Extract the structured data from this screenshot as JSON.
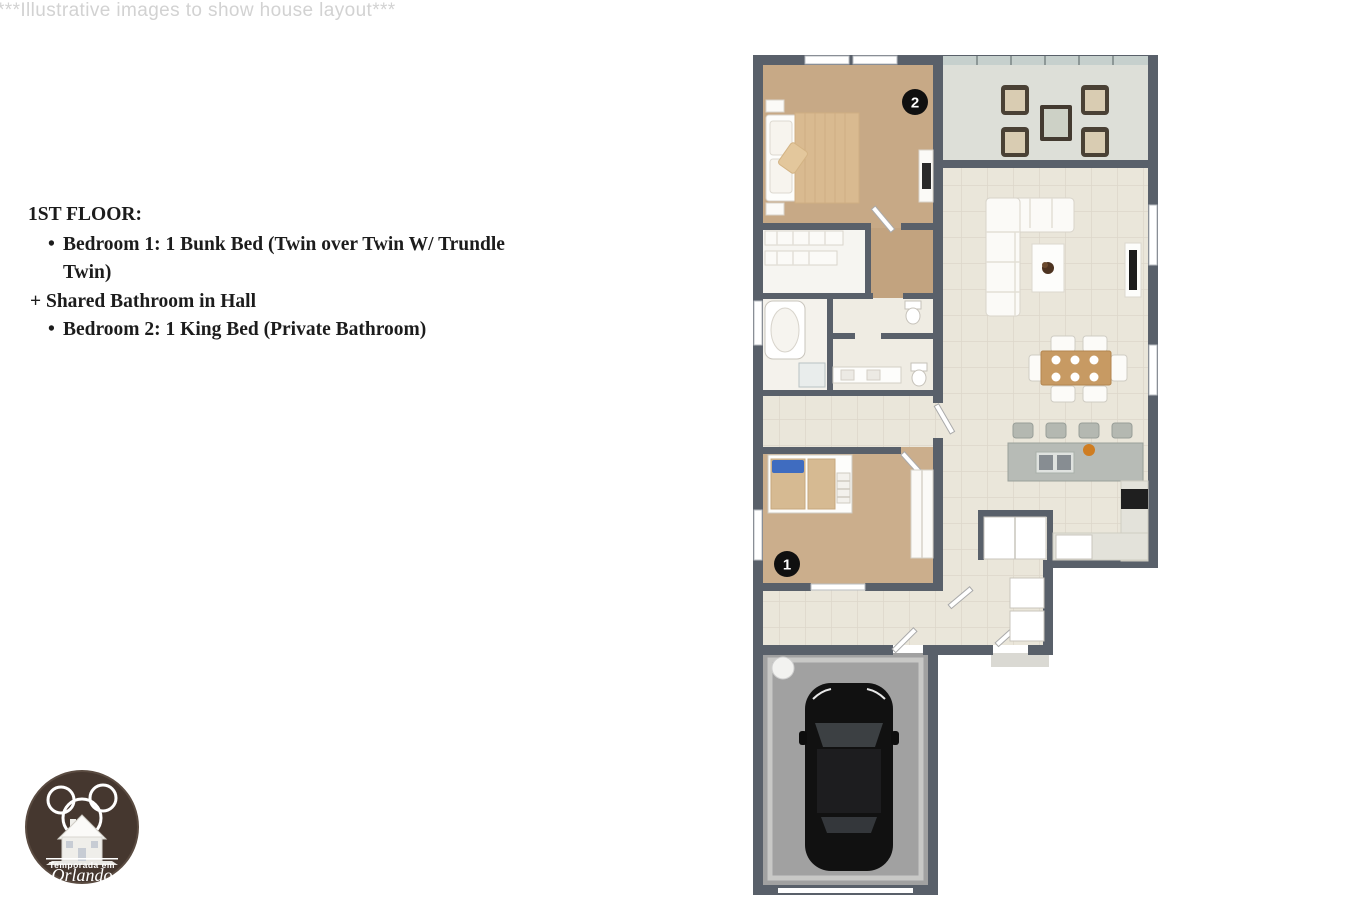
{
  "watermark": "***Illustrative images to show house layout***",
  "info": {
    "title": "1ST FLOOR:",
    "lines": [
      {
        "type": "bullet",
        "text": "Bedroom 1: 1 Bunk Bed (Twin over Twin W/ Trundle Twin)"
      },
      {
        "type": "plain",
        "text": "+ Shared Bathroom in Hall"
      },
      {
        "type": "bullet",
        "text": "Bedroom 2: 1 King Bed (Private Bathroom)"
      }
    ]
  },
  "floorplan": {
    "markers": [
      {
        "label": "2",
        "room": "bedroom-2"
      },
      {
        "label": "1",
        "room": "bedroom-1"
      }
    ]
  },
  "logo": {
    "line1": "Temporada em",
    "line2": "Orlando"
  },
  "colors": {
    "wall": "#59606a",
    "carpet": "#c7a986",
    "tile": "#eae6da",
    "patio_floor": "#dddfd8",
    "garage_floor": "#a1a1a1",
    "marker_bg": "#101010",
    "logo_bg": "#45372f",
    "text": "#1c1c1c",
    "watermark": "#d2d2d2"
  }
}
